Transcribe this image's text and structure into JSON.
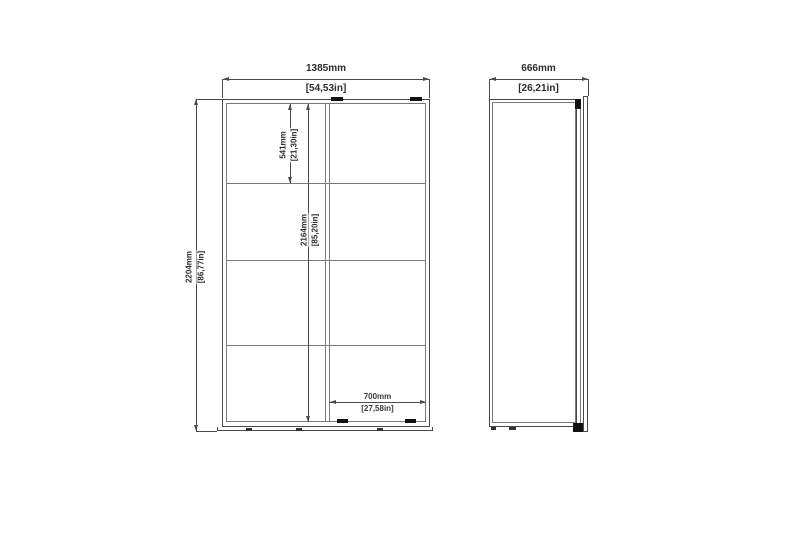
{
  "colors": {
    "background": "#ffffff",
    "line": "#4a4a4a",
    "line_light": "#7a7a7a",
    "hardware": "#111111",
    "text": "#2d2d2d"
  },
  "dimensions": {
    "front_width": {
      "mm": "1385mm",
      "in": "[54,53in]"
    },
    "front_height": {
      "mm": "2204mm",
      "in": "[86,77in]"
    },
    "top_section": {
      "mm": "541mm",
      "in": "[21,30in]"
    },
    "inner_height": {
      "mm": "2164mm",
      "in": "[85,20in]"
    },
    "door_width": {
      "mm": "700mm",
      "in": "[27,58in]"
    },
    "side_depth": {
      "mm": "666mm",
      "in": "[26,21in]"
    }
  }
}
